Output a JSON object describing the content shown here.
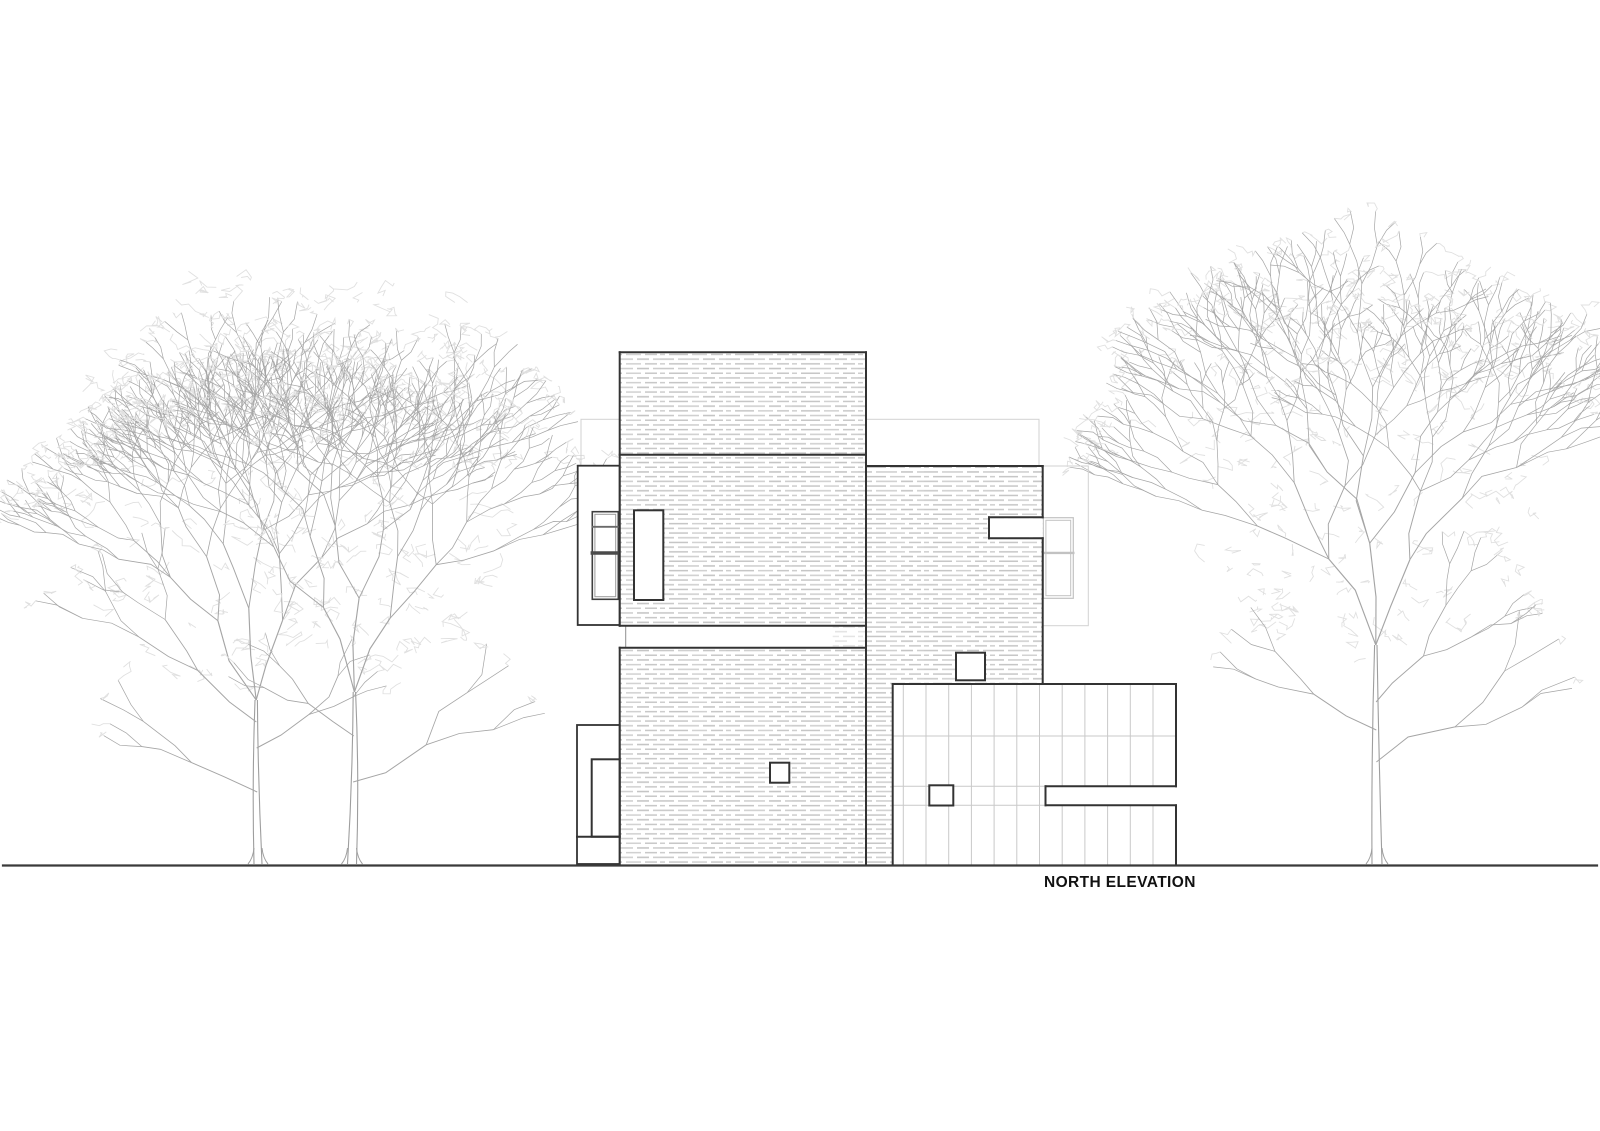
{
  "caption": {
    "label": "NORTH ELEVATION"
  },
  "canvas": {
    "width": 1600,
    "height": 1131,
    "background": "#ffffff"
  },
  "colors": {
    "dark_line": "#333333",
    "medium_line": "#8f8f8f",
    "light_line": "#cccccc",
    "bg_outline": "#d2d2d2",
    "bg_window_line": "#c2c2c2",
    "brick_dash": "#c8c8c8",
    "brick_dash_light": "#e2e2e2",
    "grid_line": "#c9c9c9",
    "ground": "#3a3a3a",
    "tree_branch": "#a5a5a5",
    "tree_trunk": "#9e9e9e",
    "tree_leaf": "#e0e0e0",
    "text": "#111111"
  },
  "ground_line": {
    "x1": 3,
    "y": 865.5,
    "x2": 1597,
    "width": 2.2
  },
  "background_outlines": {
    "rects": [
      {
        "name": "bg-roof-outline",
        "x": 581,
        "y": 419.3,
        "w": 458,
        "h": 46.7
      },
      {
        "name": "bg-right-extension-outline",
        "x": 1042.7,
        "y": 466,
        "w": 45.6,
        "h": 159.7
      }
    ],
    "window": {
      "name": "bg-right-window-outline",
      "outer": {
        "x": 1043.3,
        "y": 517.7,
        "w": 30,
        "h": 80.6
      },
      "inner_inset": 2.6,
      "divider_y": 552.9
    }
  },
  "building": {
    "brick_areas": [
      {
        "name": "upper-brick-volume",
        "x": 619.7,
        "y": 352.3,
        "w": 246.3,
        "h": 102.4
      },
      {
        "name": "middle-brick-volume",
        "x": 619.7,
        "y": 454.7,
        "w": 246.3,
        "h": 171
      },
      {
        "name": "right-brick-wing",
        "x": 866,
        "y": 466,
        "w": 176.7,
        "h": 218
      },
      {
        "name": "lower-brick-volume",
        "x": 619.7,
        "y": 647.7,
        "w": 246.3,
        "h": 216.3
      },
      {
        "name": "brick-pier-strip",
        "x": 866,
        "y": 684,
        "w": 26.7,
        "h": 180
      }
    ],
    "brick_patch": {
      "name": "recessed-brick-patch",
      "x": 832.7,
      "y": 626.5,
      "w": 33.3,
      "h": 20.5
    },
    "grid_block": {
      "name": "slatted-garage-volume",
      "x": 892.7,
      "y": 684,
      "w": 283.3,
      "h": 180,
      "first_line_offset": 10.6,
      "cell_w": 22.7,
      "h_lines": [
        736,
        786.3,
        805.3
      ]
    },
    "white_fills": [
      {
        "name": "right-wing-notch",
        "x": 989.3,
        "y": 518.3,
        "w": 53.4,
        "h": 19
      },
      {
        "name": "grid-slot",
        "x": 1046,
        "y": 787,
        "w": 130,
        "h": 17.7
      }
    ],
    "openings": [
      {
        "name": "entry-door",
        "x": 634,
        "y": 510.3,
        "w": 29.3,
        "h": 89.7
      },
      {
        "name": "left-wing-door",
        "x": 591.7,
        "y": 759.3,
        "w": 28,
        "h": 77.4
      },
      {
        "name": "square-window-right-wing",
        "x": 956,
        "y": 652.7,
        "w": 29,
        "h": 27.6
      },
      {
        "name": "small-window-lower-volume",
        "x": 770,
        "y": 762.7,
        "w": 19.3,
        "h": 20
      },
      {
        "name": "small-window-grid-block",
        "x": 929.3,
        "y": 785.3,
        "w": 24,
        "h": 20.2
      }
    ],
    "wing_outlines": [
      {
        "name": "left-upper-wing",
        "x": 577.7,
        "y": 465.7,
        "w": 42,
        "h": 159.3
      },
      {
        "name": "left-lower-wing",
        "x": 577,
        "y": 725,
        "w": 42.7,
        "h": 139
      }
    ],
    "left_window": {
      "name": "left-wing-window",
      "outer": {
        "x": 592.3,
        "y": 511.7,
        "w": 26,
        "h": 87.6
      },
      "inner_inset": 2.6,
      "divider1_y": 526.8,
      "divider2_y": 553
    },
    "dark_edges": [
      [
        619.7,
        352.3,
        866,
        352.3
      ],
      [
        619.7,
        454.7,
        866,
        454.7
      ],
      [
        619.7,
        625.7,
        866,
        625.7
      ],
      [
        619.7,
        647.7,
        866,
        647.7
      ],
      [
        619.7,
        352.3,
        619.7,
        625.7
      ],
      [
        619.7,
        647.7,
        619.7,
        864
      ],
      [
        866,
        352.3,
        866,
        864
      ],
      [
        866,
        466,
        1042.7,
        466
      ],
      [
        1042.7,
        466,
        1042.7,
        517.3
      ],
      [
        1042.7,
        538.3,
        1042.7,
        684
      ],
      [
        989,
        517.3,
        1042.7,
        517.3
      ],
      [
        989,
        517.3,
        989,
        538.3
      ],
      [
        989,
        538.3,
        1042.7,
        538.3
      ],
      [
        892.7,
        684,
        1176,
        684
      ],
      [
        892.7,
        684,
        892.7,
        864
      ],
      [
        1176,
        684,
        1176,
        786.3
      ],
      [
        1176,
        805.3,
        1176,
        864
      ],
      [
        1045.5,
        786.3,
        1176,
        786.3
      ],
      [
        1045.5,
        786.3,
        1045.5,
        805.3
      ],
      [
        1045.5,
        805.3,
        1176,
        805.3
      ],
      [
        577,
        836.7,
        619.7,
        836.7
      ]
    ],
    "thin_edges": [
      [
        625.7,
        626.7,
        625.7,
        646.7
      ]
    ]
  },
  "trees": [
    {
      "name": "left-tree-a",
      "x": 258,
      "base": 864,
      "trunk_top": 700,
      "trunk_w": 4,
      "lean": -6,
      "seed": 7,
      "arms": [
        {
          "ang": -0.45,
          "len": 88,
          "depth": 6
        },
        {
          "ang": -0.08,
          "len": 92,
          "depth": 6
        },
        {
          "ang": 0.32,
          "len": 84,
          "depth": 6
        }
      ],
      "side_branches": [
        {
          "y": 792,
          "ang": -1.15,
          "len": 72,
          "depth": 2
        },
        {
          "y": 748,
          "ang": 1.0,
          "len": 62,
          "depth": 2
        },
        {
          "y": 722,
          "ang": -0.85,
          "len": 78,
          "depth": 3
        }
      ],
      "crown": {
        "cx": 235,
        "cy": 480,
        "rx": 180,
        "ry": 205
      },
      "leaf_count": 150
    },
    {
      "name": "left-tree-b",
      "x": 352,
      "base": 864,
      "trunk_top": 692,
      "trunk_w": 4.5,
      "lean": 8,
      "seed": 13,
      "arms": [
        {
          "ang": -0.35,
          "len": 90,
          "depth": 6
        },
        {
          "ang": 0.05,
          "len": 94,
          "depth": 6
        },
        {
          "ang": 0.45,
          "len": 82,
          "depth": 6
        }
      ],
      "side_branches": [
        {
          "y": 782,
          "ang": 1.1,
          "len": 82,
          "depth": 2
        },
        {
          "y": 736,
          "ang": -0.95,
          "len": 56,
          "depth": 2
        }
      ],
      "crown": {
        "cx": 375,
        "cy": 470,
        "rx": 148,
        "ry": 205
      },
      "leaf_count": 130
    },
    {
      "name": "right-tree",
      "x": 1377,
      "base": 864,
      "trunk_top": 645,
      "trunk_w": 5,
      "lean": -4,
      "seed": 21,
      "arms": [
        {
          "ang": -0.5,
          "len": 98,
          "depth": 6
        },
        {
          "ang": -0.06,
          "len": 102,
          "depth": 6
        },
        {
          "ang": 0.38,
          "len": 92,
          "depth": 6
        }
      ],
      "side_branches": [
        {
          "y": 762,
          "ang": 1.15,
          "len": 86,
          "depth": 2
        },
        {
          "y": 730,
          "ang": -1.05,
          "len": 72,
          "depth": 2
        },
        {
          "y": 702,
          "ang": 0.8,
          "len": 66,
          "depth": 3
        }
      ],
      "crown": {
        "cx": 1368,
        "cy": 460,
        "rx": 185,
        "ry": 200
      },
      "leaf_count": 170
    }
  ]
}
